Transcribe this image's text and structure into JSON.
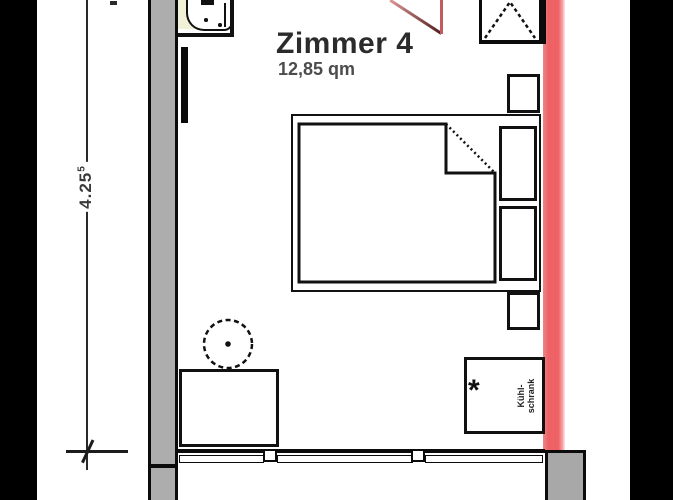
{
  "plan": {
    "room_name": "Zimmer 4",
    "room_area": "12,85 qm",
    "dimension": {
      "value": "4.25",
      "superscript": "5"
    },
    "fridge": {
      "asterisk": "*",
      "label_lines": [
        "Kühl-",
        "schrank"
      ]
    },
    "colors": {
      "highlight_wall_red": "#ee6165",
      "wall_gray": "#adadad",
      "sink_counter_cream": "#f1f1d8",
      "door_leaf_dark_red": "#511d1d",
      "line_black": "#111111"
    }
  }
}
